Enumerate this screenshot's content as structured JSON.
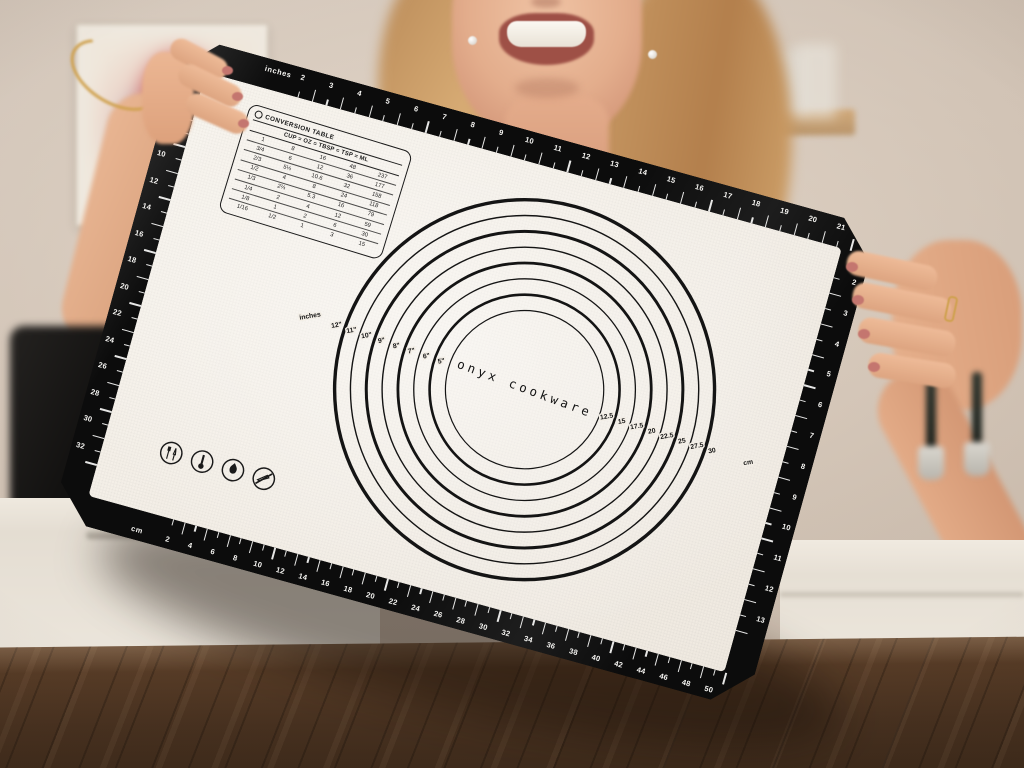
{
  "mat": {
    "brand": "onyx cookware",
    "rulers": {
      "top": {
        "unit_label": "inches",
        "numbers": [
          2,
          3,
          4,
          5,
          6,
          7,
          8,
          9,
          10,
          11,
          12,
          13,
          14,
          15,
          16,
          17,
          18,
          19,
          20,
          21
        ]
      },
      "bottom": {
        "unit_label": "cm",
        "numbers": [
          2,
          4,
          6,
          8,
          10,
          12,
          14,
          16,
          18,
          20,
          22,
          24,
          26,
          28,
          30,
          32,
          34,
          36,
          38,
          40,
          42,
          44,
          46,
          48,
          50
        ]
      },
      "left": {
        "numbers": [
          6,
          8,
          10,
          12,
          14,
          16,
          18,
          20,
          22,
          24,
          26,
          28,
          30,
          32
        ]
      },
      "right": {
        "numbers": [
          2,
          3,
          4,
          5,
          6,
          7,
          8,
          9,
          10,
          11,
          12,
          13
        ]
      }
    },
    "conversion_table": {
      "title": "CONVERSION TABLE",
      "header": [
        "CUP",
        "OZ",
        "TBSP",
        "TSP",
        "ML"
      ],
      "rows": [
        [
          "1",
          "8",
          "16",
          "48",
          "237"
        ],
        [
          "3/4",
          "6",
          "12",
          "36",
          "177"
        ],
        [
          "2/3",
          "5⅓",
          "10.6",
          "32",
          "158"
        ],
        [
          "1/2",
          "4",
          "8",
          "24",
          "118"
        ],
        [
          "1/3",
          "2⅔",
          "5.3",
          "16",
          "79"
        ],
        [
          "1/4",
          "2",
          "4",
          "12",
          "59"
        ],
        [
          "1/8",
          "1",
          "2",
          "6",
          "30"
        ],
        [
          "1/16",
          "1/2",
          "1",
          "3",
          "15"
        ]
      ]
    },
    "circle_guide": {
      "unit_label_inches": "inches",
      "inch_labels": [
        "12\"",
        "11\"",
        "10\"",
        "9\"",
        "8\"",
        "7\"",
        "6\"",
        "5\""
      ],
      "cm_labels": [
        "12.5",
        "15",
        "17.5",
        "20",
        "22.5",
        "25",
        "27.5",
        "30"
      ],
      "unit_label_cm": "cm"
    },
    "care_icons": [
      "food-safe",
      "thermometer",
      "flame-resistant",
      "do-not-cut"
    ],
    "colors": {
      "border": "#0c0c0c",
      "surface": "#f3eee6",
      "print": "#141414"
    }
  }
}
